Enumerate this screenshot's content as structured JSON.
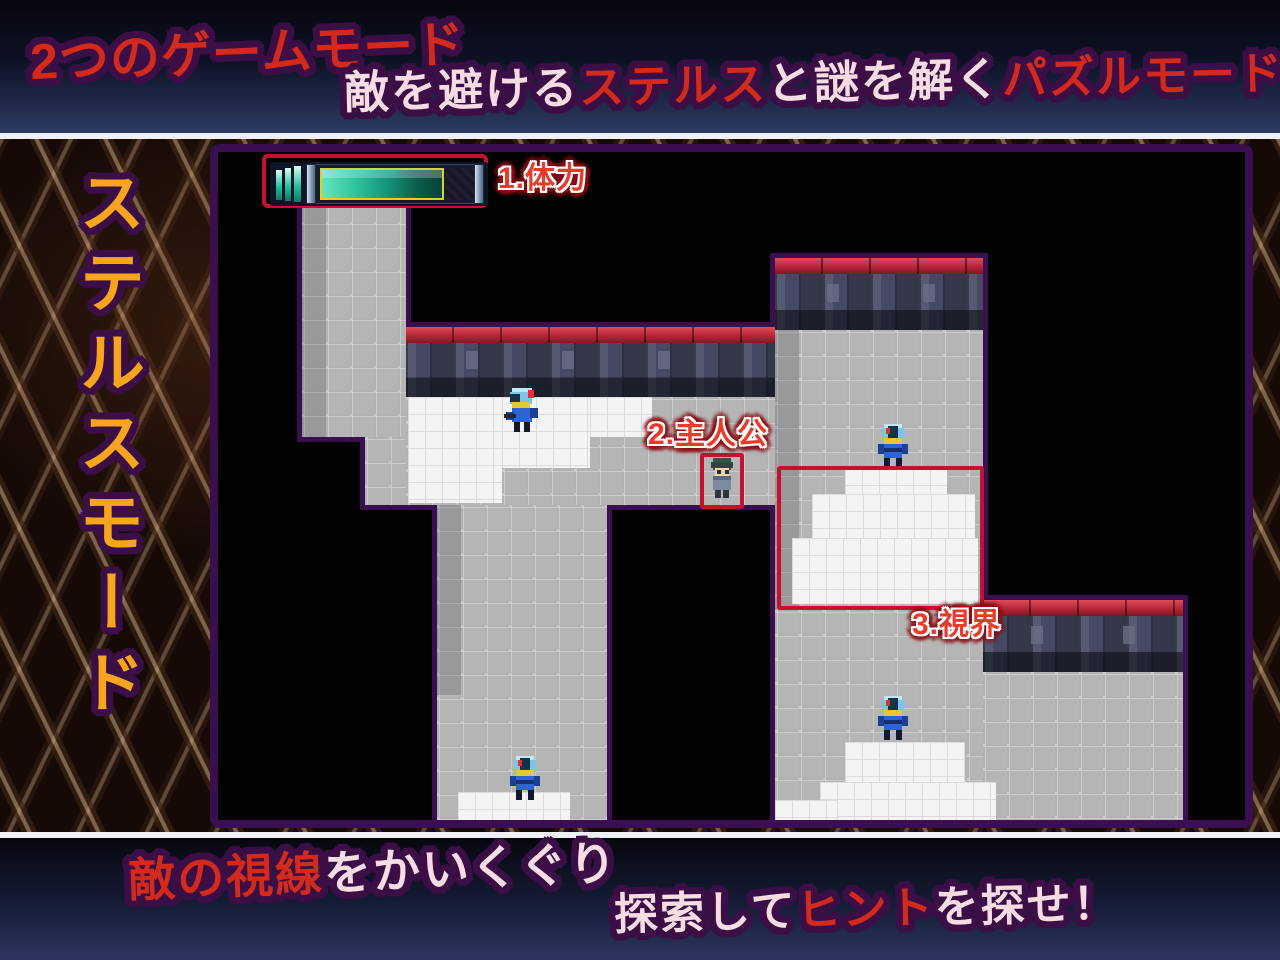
{
  "banner_top": {
    "line1_segments": [
      {
        "t": "2つの",
        "c": "red"
      },
      {
        "t": "ゲームモード",
        "c": "red"
      }
    ],
    "line1_full": "2つのゲームモード",
    "line2_segments": [
      {
        "t": "敵を避ける",
        "c": "pink"
      },
      {
        "t": "ステルス",
        "c": "red"
      },
      {
        "t": "と謎を解く",
        "c": "pink"
      },
      {
        "t": "パズルモード!!",
        "c": "red"
      }
    ],
    "line2_full": "敵を避けるステルスと謎を解くパズルモード!!"
  },
  "sidebar": {
    "vertical_title": "ステルスモード"
  },
  "banner_bottom": {
    "line1_segments": [
      {
        "t": "敵の視線",
        "c": "red"
      },
      {
        "t": "をかいくぐり",
        "c": "pink"
      }
    ],
    "line1_full": "敵の視線をかいくぐり",
    "line2_segments": [
      {
        "t": "探索して",
        "c": "pink"
      },
      {
        "t": "ヒント",
        "c": "red"
      },
      {
        "t": "を探せ！",
        "c": "pink"
      }
    ],
    "line2_full": "探索してヒントを探せ！"
  },
  "hud": {
    "label": "1.体力",
    "hp_percent": 100,
    "segment_bars": 3
  },
  "callouts": {
    "health": "1.体力",
    "protagonist": "2.主人公",
    "vision": "3.視界"
  },
  "map": {
    "tile_size_px": 24,
    "characters": [
      {
        "name": "enemy-guard-1",
        "type": "armored-knight",
        "facing": "left"
      },
      {
        "name": "enemy-guard-2",
        "type": "armored-knight",
        "facing": "down"
      },
      {
        "name": "enemy-guard-3",
        "type": "armored-knight",
        "facing": "down"
      },
      {
        "name": "enemy-guard-4",
        "type": "armored-knight",
        "facing": "down"
      },
      {
        "name": "protagonist",
        "type": "student",
        "facing": "down"
      }
    ],
    "highlight_boxes": [
      "health-gauge",
      "protagonist",
      "enemy-vision-area"
    ]
  },
  "colors": {
    "accent_red_box": "#c5102f",
    "label_red": "#ea3a2a",
    "text_red": "#d32a1c",
    "text_pink": "#f7dce3",
    "sidebar_orange": "#f7a51d",
    "outline_purple": "#3b0f46",
    "panel_border_purple": "#3a0f50",
    "hp_teal": "#2cc09c",
    "wall_red_cap": "#b52638"
  }
}
